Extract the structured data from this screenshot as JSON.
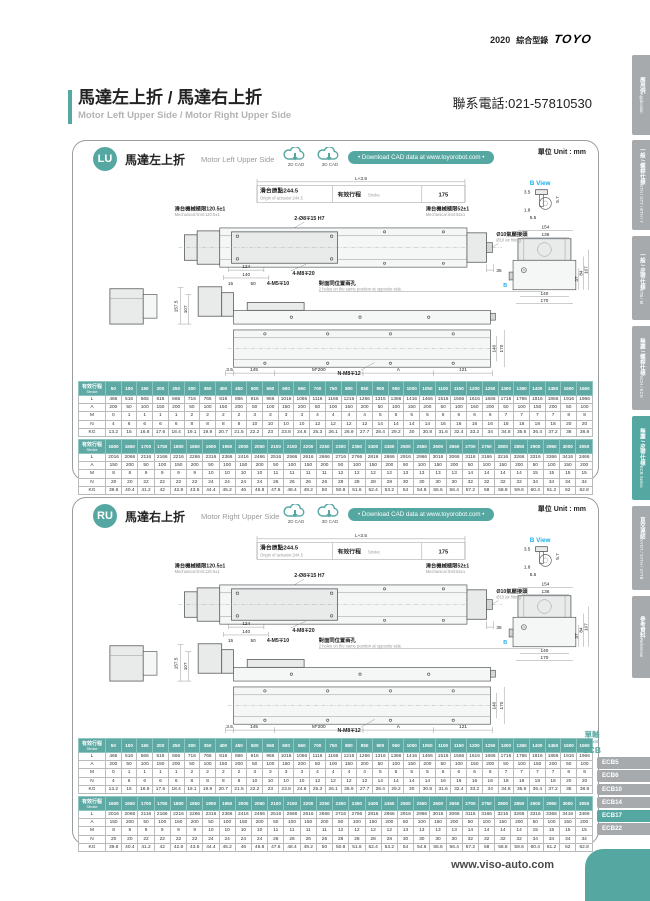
{
  "colors": {
    "accent": "#55a7a1",
    "tab_gray": "#a6aaad",
    "cyan": "#1fb0e8",
    "table_header": "#5fa9a4"
  },
  "header": {
    "year": "2020",
    "catalog": "綜合型錄",
    "logo": "TOYO",
    "contact": "聯系電話:021-57810530",
    "title_zh": "馬達左上折 / 馬達右上折",
    "title_en": "Motor Left Upper Side / Motor Right Upper Side"
  },
  "sidebar": {
    "tabs": [
      {
        "zh": "應用例",
        "en": "Application",
        "active": false
      },
      {
        "zh": "一般 / 螺桿仕樣",
        "en": "GTH / GTY / ETH / Y",
        "active": false
      },
      {
        "zh": "一般 / 皮帶仕樣",
        "en": "ETB / M",
        "active": false
      },
      {
        "zh": "無塵 / 螺桿仕樣",
        "en": "GCH / ECH",
        "active": false
      },
      {
        "zh": "無塵 / 皮帶仕樣",
        "en": "ECB Series",
        "active": true
      },
      {
        "zh": "直交連結",
        "en": "XYGT / XYTH / XYTB",
        "active": false
      },
      {
        "zh": "參考資料",
        "en": "Reference",
        "active": false
      }
    ]
  },
  "download": {
    "cad_2d": "2D CAD",
    "cad_3d": "3D CAD",
    "pill": "• Download CAD data at www.toyorobot.com •",
    "unit": "單位 Unit : mm"
  },
  "panels": [
    {
      "code": "LU",
      "title_zh": "馬達左上折",
      "title_en": "Motor Left Upper Side"
    },
    {
      "code": "RU",
      "title_zh": "馬達右上折",
      "title_en": "Motor Right Upper Side"
    }
  ],
  "drawing": {
    "dim_total": "L+3.5",
    "origin_zh": "滑台原點244.5",
    "origin_en": "Origin of actuator:244.5",
    "stroke_zh": "有效行程",
    "stroke_en": "Stroke",
    "dim_175": "175",
    "mech_left_zh": "滑台機械極限120.5±1",
    "mech_left_en": "Mechanical limit:120.5±1",
    "mech_right_zh": "滑台機械極限52±1",
    "mech_right_en": "Mechanical limit:52±1",
    "holes_top": "2-Ø8∓15 H7",
    "air_zh": "Ø10氣壓接頭",
    "air_en": "Ø10 air fitting",
    "dim_35": "35",
    "dim_124": "124",
    "dim_140": "140",
    "screw_slide": "4-M8∓20",
    "dim_15": "15",
    "dim_50": "50",
    "screw_side": "4-M5∓10",
    "note_zh": "對面同位置兩孔",
    "note_en": "2 holes on the same position at opposite side.",
    "dim_157_5": "157.5",
    "dim_107": "107",
    "dim_3_5": "3.5",
    "dim_145": "145",
    "dim_m200": "M*200",
    "dim_A": "A",
    "dim_121": "121",
    "screw_bottom": "N-M8∓12",
    "dim_140b": "140",
    "dim_170": "170",
    "bview_title": "B View",
    "bv_3_5": "3.5",
    "bv_5_7": "5.7",
    "bv_1_8": "1.8",
    "bv_5_5": "5.5",
    "ev_154": "154",
    "ev_136": "136",
    "ev_84": "84",
    "ev_107": "107",
    "ev_37": "37",
    "ev_140": "140",
    "ev_170": "170",
    "b_marker": "B"
  },
  "tables": {
    "header_label_zh": "有效行程",
    "header_label_en": "Stroke",
    "row_labels": [
      "L",
      "A",
      "M",
      "N",
      "KG"
    ],
    "table1": {
      "strokes": [
        50,
        100,
        150,
        200,
        250,
        300,
        350,
        400,
        450,
        500,
        550,
        600,
        650,
        700,
        750,
        800,
        850,
        900,
        950,
        1000,
        1050,
        1100,
        1150,
        1200,
        1250,
        1300,
        1350,
        1400,
        1450,
        1500,
        1550
      ],
      "L": [
        466,
        516,
        566,
        616,
        666,
        716,
        766,
        816,
        866,
        916,
        966,
        1016,
        1066,
        1116,
        1166,
        1216,
        1266,
        1316,
        1366,
        1416,
        1466,
        1516,
        1566,
        1616,
        1666,
        1716,
        1766,
        1816,
        1866,
        1916,
        1966
      ],
      "A": [
        200,
        50,
        100,
        150,
        200,
        50,
        100,
        150,
        200,
        50,
        100,
        150,
        200,
        50,
        100,
        150,
        200,
        50,
        100,
        150,
        200,
        50,
        100,
        150,
        200,
        50,
        100,
        150,
        200,
        50,
        100
      ],
      "M": [
        0,
        1,
        1,
        1,
        1,
        2,
        2,
        2,
        2,
        3,
        3,
        3,
        3,
        4,
        4,
        4,
        4,
        5,
        5,
        5,
        5,
        6,
        6,
        6,
        6,
        7,
        7,
        7,
        7,
        8,
        8
      ],
      "N": [
        4,
        6,
        6,
        6,
        6,
        8,
        8,
        8,
        8,
        10,
        10,
        10,
        10,
        12,
        12,
        12,
        12,
        14,
        14,
        14,
        14,
        16,
        16,
        16,
        16,
        18,
        18,
        18,
        18,
        20,
        20
      ],
      "KG": [
        13.2,
        15,
        16.8,
        17.6,
        18.4,
        19.1,
        19.9,
        20.7,
        21.5,
        22.2,
        23,
        23.8,
        24.6,
        25.3,
        26.1,
        26.9,
        27.7,
        28.4,
        29.2,
        30,
        30.8,
        31.6,
        32.4,
        33.2,
        34,
        34.8,
        35.6,
        36.4,
        37.2,
        38,
        38.8
      ]
    },
    "table2": {
      "strokes": [
        1600,
        1650,
        1700,
        1750,
        1800,
        1850,
        1900,
        1950,
        2000,
        2050,
        2100,
        2150,
        2200,
        2250,
        2300,
        2350,
        2400,
        2450,
        2500,
        2550,
        2600,
        2650,
        2700,
        2750,
        2800,
        2850,
        2900,
        2950,
        3000,
        3050
      ],
      "L": [
        2016,
        2066,
        2116,
        2166,
        2216,
        2266,
        2316,
        2366,
        2416,
        2466,
        2516,
        2566,
        2616,
        2666,
        2716,
        2766,
        2816,
        2866,
        2916,
        2966,
        3016,
        3066,
        3116,
        3166,
        3216,
        3266,
        3316,
        3366,
        3416,
        3466
      ],
      "A": [
        150,
        200,
        50,
        100,
        150,
        200,
        50,
        100,
        150,
        200,
        50,
        100,
        150,
        200,
        50,
        100,
        150,
        200,
        50,
        100,
        150,
        200,
        50,
        100,
        150,
        200,
        50,
        100,
        150,
        200
      ],
      "M": [
        8,
        8,
        9,
        9,
        9,
        9,
        10,
        10,
        10,
        10,
        11,
        11,
        11,
        11,
        12,
        12,
        12,
        12,
        13,
        13,
        13,
        13,
        14,
        14,
        14,
        14,
        15,
        15,
        15,
        15
      ],
      "N": [
        20,
        20,
        22,
        22,
        22,
        22,
        24,
        24,
        24,
        24,
        26,
        26,
        26,
        26,
        28,
        28,
        28,
        28,
        30,
        30,
        30,
        30,
        32,
        32,
        32,
        32,
        34,
        34,
        34,
        34
      ],
      "KG": [
        39.6,
        40.4,
        41.2,
        42,
        42.8,
        43.6,
        44.4,
        45.2,
        46,
        46.8,
        47.6,
        48.4,
        49.2,
        50,
        50.8,
        51.6,
        52.4,
        53.2,
        54,
        54.8,
        55.6,
        56.4,
        57.2,
        58,
        58.8,
        59.6,
        60.4,
        61.2,
        62,
        62.8
      ]
    }
  },
  "product_nav": {
    "group_zh": "單軸",
    "group_en": "1 axis",
    "series": "ECB",
    "items": [
      {
        "label": "ECB5",
        "active": false
      },
      {
        "label": "ECB6",
        "active": false
      },
      {
        "label": "ECB10",
        "active": false
      },
      {
        "label": "ECB14",
        "active": false
      },
      {
        "label": "ECB17",
        "active": true
      },
      {
        "label": "ECB22",
        "active": false
      }
    ]
  },
  "footer": {
    "website": "www.viso-auto.com"
  }
}
